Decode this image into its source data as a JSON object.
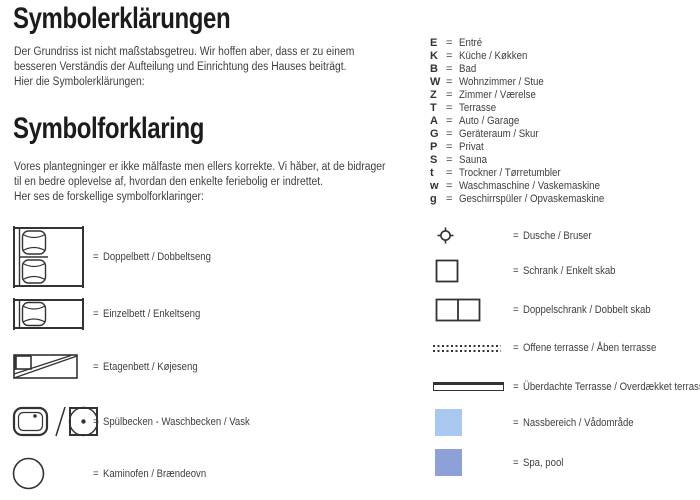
{
  "ui": {
    "equals": "=",
    "slash_separator": "/"
  },
  "intro": {
    "german": {
      "title": "Symbolerklärungen",
      "body": "Der Grundriss ist nicht maßstabsgetreu. Wir hoffen aber, dass er zu einem\nbesseren Verständis der Aufteilung und Einrichtung des Hauses beiträgt.\nHier die Symbolerklärungen:"
    },
    "danish": {
      "title": "Symbolforklaring",
      "body": "Vores plantegninger er ikke målfaste men ellers korrekte. Vi håber, at de bidrager\ntil en bedre oplevelse af, hvordan den enkelte feriebolig er indrettet.\nHer ses de forskellige symbolforklaringer:"
    }
  },
  "abbreviations": [
    {
      "letter": "E",
      "label": "Entré"
    },
    {
      "letter": "K",
      "label": "Küche / Køkken"
    },
    {
      "letter": "B",
      "label": "Bad"
    },
    {
      "letter": "W",
      "label": "Wohnzimmer / Stue"
    },
    {
      "letter": "Z",
      "label": "Zimmer / Værelse"
    },
    {
      "letter": "T",
      "label": "Terrasse"
    },
    {
      "letter": "A",
      "label": "Auto / Garage"
    },
    {
      "letter": "G",
      "label": "Geräteraum / Skur"
    },
    {
      "letter": "P",
      "label": "Privat"
    },
    {
      "letter": "S",
      "label": "Sauna"
    },
    {
      "letter": "t",
      "label": "Trockner / Tørretumbler"
    },
    {
      "letter": "w",
      "label": "Waschmaschine / Vaskemaskine"
    },
    {
      "letter": "g",
      "label": "Geschirrspüler / Opvaskemaskine"
    }
  ],
  "legend_left": [
    {
      "icon": "double-bed-icon",
      "label": "Doppelbett / Dobbeltseng"
    },
    {
      "icon": "single-bed-icon",
      "label": "Einzelbett / Enkeltseng"
    },
    {
      "icon": "bunk-bed-icon",
      "label": "Etagenbett / Køjeseng"
    },
    {
      "icon": "sink-washbasin-icons",
      "label": "Spülbecken - Waschbecken / Vask"
    },
    {
      "icon": "wood-stove-icon",
      "label": "Kaminofen / Brændeovn"
    }
  ],
  "legend_right": [
    {
      "icon": "shower-icon",
      "label": "Dusche / Bruser"
    },
    {
      "icon": "single-cabinet-icon",
      "label": "Schrank / Enkelt skab"
    },
    {
      "icon": "double-cabinet-icon",
      "label": "Doppelschrank / Dobbelt skab"
    },
    {
      "icon": "open-terrace-icon",
      "label": "Offene terrasse / Åben terrasse"
    },
    {
      "icon": "covered-terrace-icon",
      "label": "Überdachte Terrasse / Overdækket terrasse"
    },
    {
      "icon": "wet-area-swatch",
      "label": "Nassbereich / Vådområde"
    },
    {
      "icon": "spa-pool-swatch",
      "label": "Spa, pool"
    }
  ],
  "colors": {
    "wet_area": "#a9c8ef",
    "spa_pool": "#8da1d8",
    "line_art": "#333333",
    "text": "#3f3f3f",
    "heading": "#1c1c1c"
  }
}
